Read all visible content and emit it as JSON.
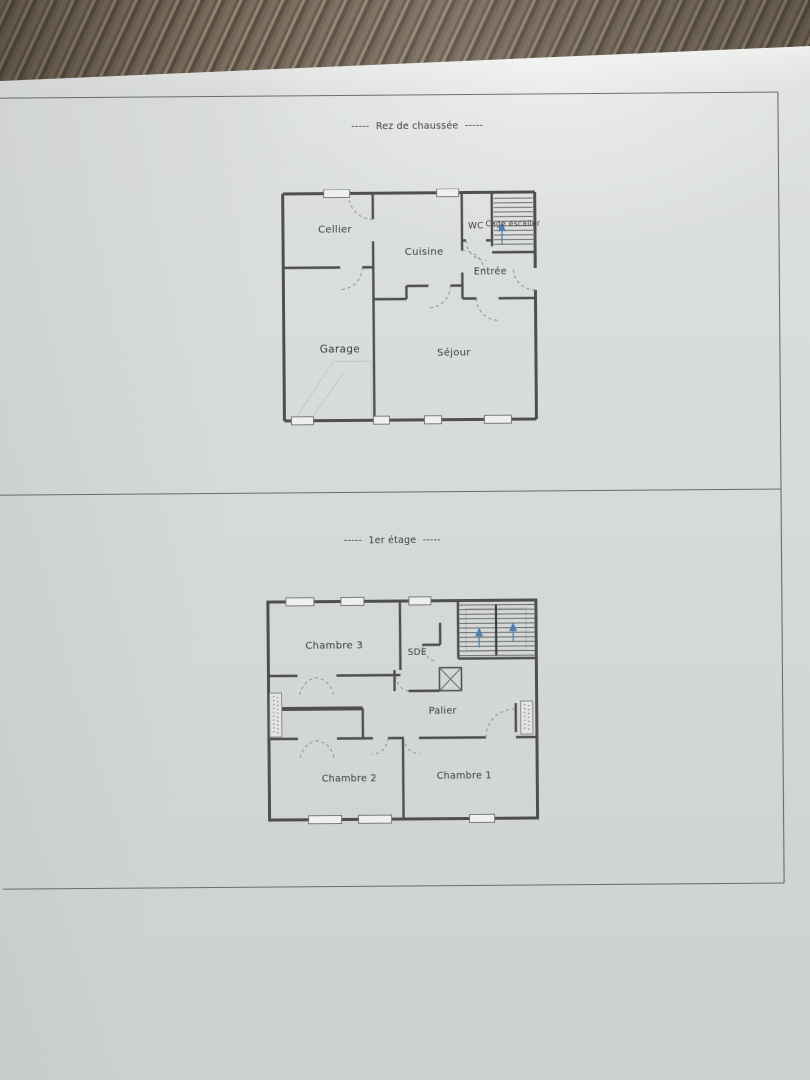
{
  "floors": [
    {
      "title": "-----  Rez de chaussée  -----",
      "rooms": {
        "cellier": "Cellier",
        "cuisine": "Cuisine",
        "wc": "WC",
        "cage_escalier": "Cage escalier",
        "entree": "Entrée",
        "garage": "Garage",
        "sejour": "Séjour"
      }
    },
    {
      "title": "-----  1er étage  -----",
      "rooms": {
        "chambre3": "Chambre 3",
        "sde": "SDE",
        "palier": "Palier",
        "chambre2": "Chambre 2",
        "chambre1": "Chambre 1"
      }
    }
  ],
  "colors": {
    "stair_arrow_blue": "#4e7fb0",
    "plan_line": "#4f4f4f"
  }
}
